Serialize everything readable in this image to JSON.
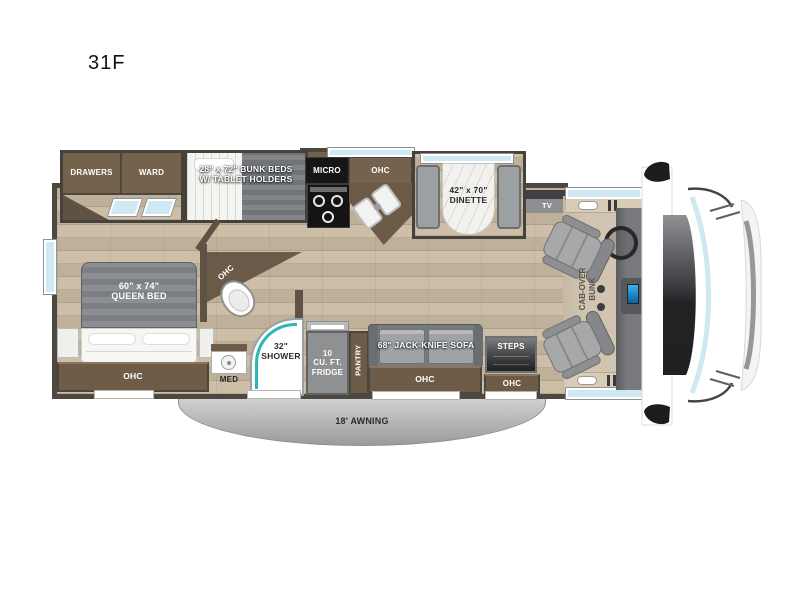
{
  "page": {
    "title": "31F"
  },
  "floorplan": {
    "model": "31F",
    "bedroom": {
      "drawers": "DRAWERS",
      "ward": "WARD",
      "queen_line1": "60\" x 74\"",
      "queen_line2": "QUEEN BED",
      "bed_ohc": "OHC"
    },
    "bunks": {
      "line1": "28\" x 72\" BUNK BEDS",
      "line2": "W/ TABLET HOLDERS"
    },
    "kitchen": {
      "micro": "MICRO",
      "ohc": "OHC",
      "fridge_line1": "10",
      "fridge_line2": "CU. FT.",
      "fridge_line3": "FRIDGE",
      "pantry": "PANTRY"
    },
    "bath": {
      "ohc": "OHC",
      "med": "MED",
      "shower_line1": "32\"",
      "shower_line2": "SHOWER"
    },
    "dinette": {
      "line1": "42\" x 70\"",
      "line2": "DINETTE"
    },
    "living": {
      "tv": "TV",
      "sofa": "68\" JACK-KNIFE SOFA",
      "sofa_ohc": "OHC",
      "steps": "STEPS",
      "entry_ohc": "OHC"
    },
    "cab": {
      "line1": "CAB-OVER",
      "line2": "BUNK"
    },
    "exterior": {
      "awning": "18' AWNING"
    },
    "colors": {
      "wood_floor": "#c9b9a2",
      "cabinet_brown": "#75624d",
      "wall_dark": "#4b463e",
      "window_blue": "#cfe9f4",
      "shower_teal": "#2fb5b5",
      "mattress_gray": "#85888c",
      "bench_gray": "#9da0a2",
      "awning_gray": "#b9b9b9",
      "appliance_black": "#141414",
      "cab_floor_beige": "#d1c5b2",
      "screen_blue": "#2aa7e8"
    }
  }
}
